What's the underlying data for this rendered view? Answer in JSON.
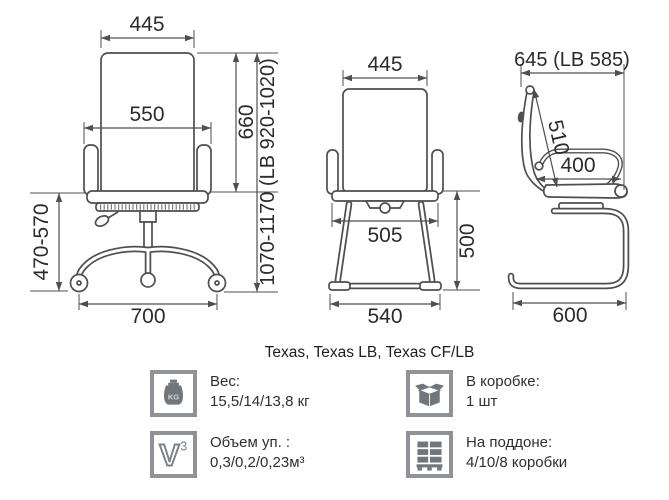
{
  "title": "Texas, Texas LB, Texas CF/LB",
  "colors": {
    "line": "#4f4f4f",
    "dim_text": "#2b2b2b",
    "icon_gray": "#71767c",
    "icon_border": "#8f9296"
  },
  "views": {
    "front": {
      "back_width": "445",
      "shoulder_width": "550",
      "back_height": "660",
      "overall_height": "1070-1170 (LB 920-1020)",
      "seat_height_range": "470-570",
      "base_width": "700"
    },
    "front_cf": {
      "back_width": "445",
      "seat_width": "505",
      "seat_height": "500",
      "base_width": "540"
    },
    "side": {
      "overall_depth": "645 (LB 585)",
      "back_length": "510",
      "arm_depth": "400",
      "base_depth": "600"
    }
  },
  "specs": {
    "weight": {
      "icon": "weight-kg-icon",
      "label": "Вес:",
      "value": "15,5/14/13,8 кг"
    },
    "per_box": {
      "icon": "box-icon",
      "label": "В коробке:",
      "value": "1 шт"
    },
    "volume": {
      "icon": "volume-v3-icon",
      "label": "Объем уп. :",
      "value": "0,3/0,2/0,23м³"
    },
    "pallet": {
      "icon": "pallet-icon",
      "label": "На поддоне:",
      "value": "4/10/8 коробки"
    }
  },
  "icon_glyphs": {
    "kg": "KG",
    "v": "V",
    "v_sup": "3"
  }
}
